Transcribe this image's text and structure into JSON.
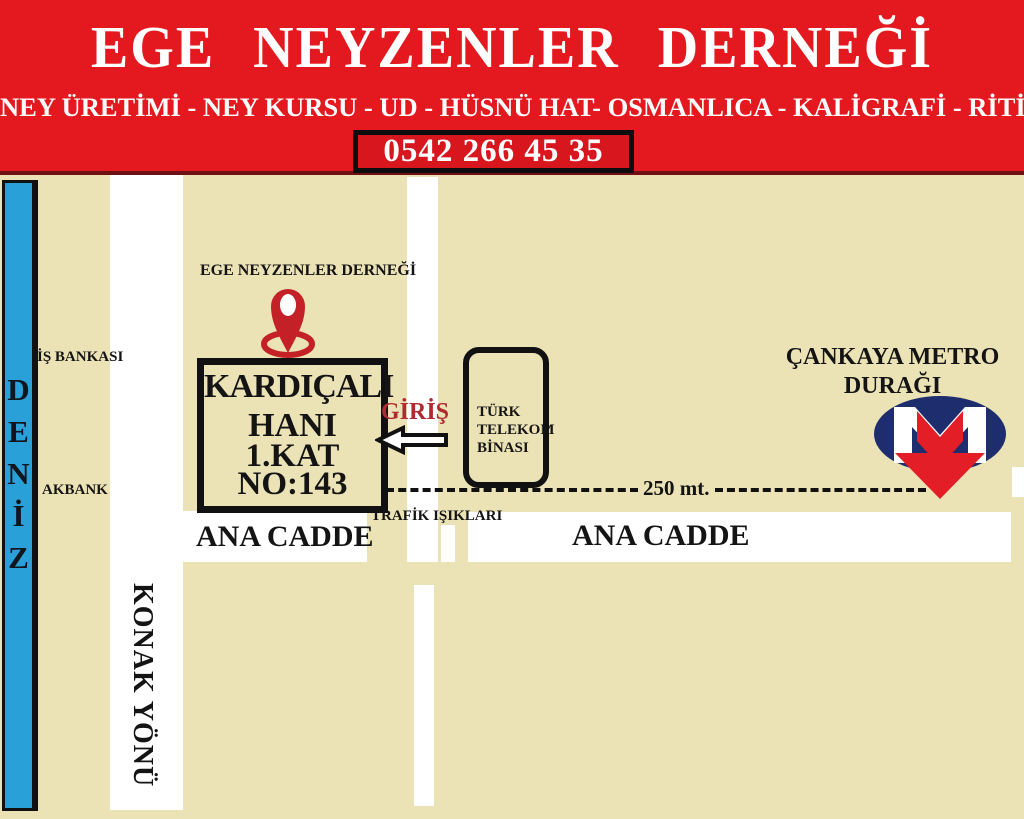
{
  "header": {
    "title": "EGE NEYZENLER DERNEĞİ",
    "subtitle": "NEY ÜRETİMİ - NEY KURSU - UD - HÜSNÜ HAT- OSMANLICA - KALİGRAFİ - RİTİM -",
    "phone": "0542 266 45 35"
  },
  "map": {
    "sea_letters": [
      "D",
      "E",
      "N",
      "İ",
      "Z"
    ],
    "is_bankasi_label": "İŞ BANKASI",
    "akbank_label": "AKBANK",
    "dernegi_label": "EGE NEYZENLER DERNEĞİ",
    "building_box": {
      "line1": "KARDIÇALI",
      "line2": "HANI",
      "line3": "1.KAT",
      "line4": "NO:143"
    },
    "telekom_box": {
      "line1": "TÜRK",
      "line2": "TELEKOM",
      "line3": "BİNASI"
    },
    "giris_label": "GİRİŞ",
    "distance_label": "250 mt.",
    "trafik_label": "TRAFİK IŞIKLARI",
    "ana_cadde_left": "ANA CADDE",
    "ana_cadde_right": "ANA CADDE",
    "konak_label": "KONAK YÖNÜ",
    "metro_stop": {
      "line1": "ÇANKAYA METRO",
      "line2": "DURAĞI"
    },
    "icons": {
      "pin": "map-pin-icon",
      "metro": "metro-logo",
      "entrance_arrow": "left-arrow-icon"
    }
  },
  "colors": {
    "banner_red": "#e4191f",
    "phone_box_red": "#d8161d",
    "beige": "#ebe2b6",
    "sea_blue": "#29a0d8",
    "road_white": "#ffffff",
    "giris_red": "#b02a30",
    "pin_red": "#c32028",
    "metro_navy": "#1d2d6e",
    "metro_red": "#e41e26",
    "ink_black": "#141414"
  }
}
